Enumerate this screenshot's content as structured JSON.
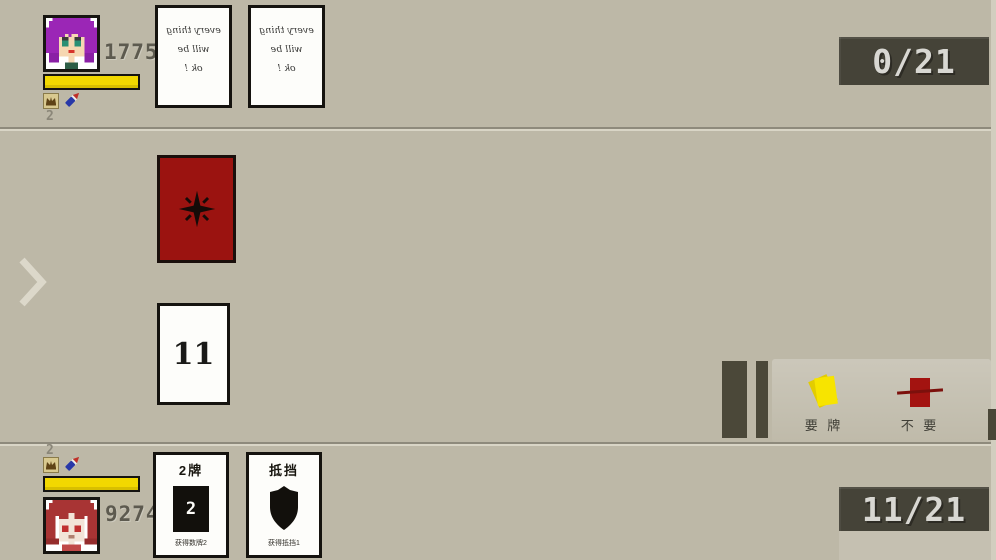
{
  "colors": {
    "background": "#bdb8a7",
    "hp_bar_yellow": "#f2d800",
    "card_red": "#9b1310",
    "badge_dark": "#454338",
    "hit_yellow": "#f7e400"
  },
  "opponent": {
    "hp": "17759",
    "resource_count": "2",
    "score": "0/21",
    "cards": [
      {
        "lines": [
          "every thing",
          "will be",
          "ok !"
        ]
      },
      {
        "lines": [
          "every thing",
          "will be",
          "ok !"
        ]
      }
    ]
  },
  "board": {
    "deck_card_icon": "star-burst",
    "drawn_card_value": "11"
  },
  "actions": {
    "hit": {
      "label": "要 牌",
      "icon": "yellow-cards"
    },
    "stand": {
      "label": "不 要",
      "icon": "red-card-crossed"
    }
  },
  "player": {
    "hp": "9274",
    "resource_count": "2",
    "score": "11/21",
    "hand": [
      {
        "title": "2牌",
        "value": "2",
        "caption": "获得数牌2",
        "icon": "number-card"
      },
      {
        "title": "抵挡",
        "caption": "获得抵挡1",
        "icon": "shield"
      }
    ]
  }
}
